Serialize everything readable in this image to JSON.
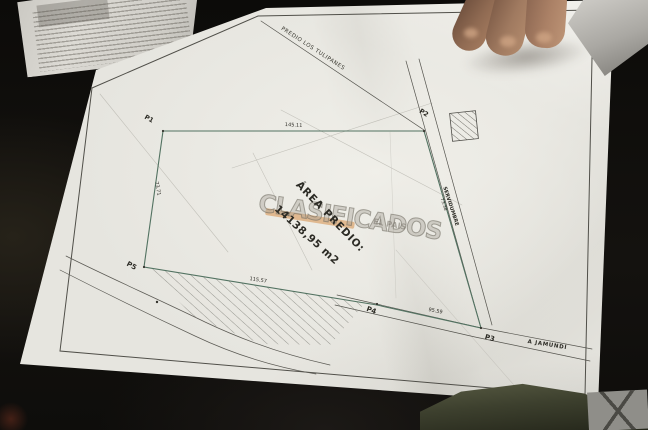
{
  "plan": {
    "neighbor_label": "PREDIO LOS TULIPANES",
    "area_label": "ÁREA PREDIO:",
    "area_value": "14138,95 m2",
    "servidumbre_label": "SERVIDUMBRE",
    "servidumbre_value": "73.38",
    "road_label": "A JAMUNDÍ",
    "points": {
      "p1": "P1",
      "p2": "P2",
      "p3": "P3",
      "p4": "P4",
      "p5": "P5"
    },
    "measurements": {
      "north_side": "145.11",
      "west_side": "73.71",
      "south_west_side": "115.57",
      "south_east_side": "95.59"
    }
  },
  "watermark": {
    "text": "CLASIFICADOS",
    "subtext": "EL PAIS",
    "bar_color": "#d99a5b"
  },
  "colors": {
    "paper": "#e6e5df",
    "background": "#12100d",
    "boundary_line": "#527261"
  }
}
